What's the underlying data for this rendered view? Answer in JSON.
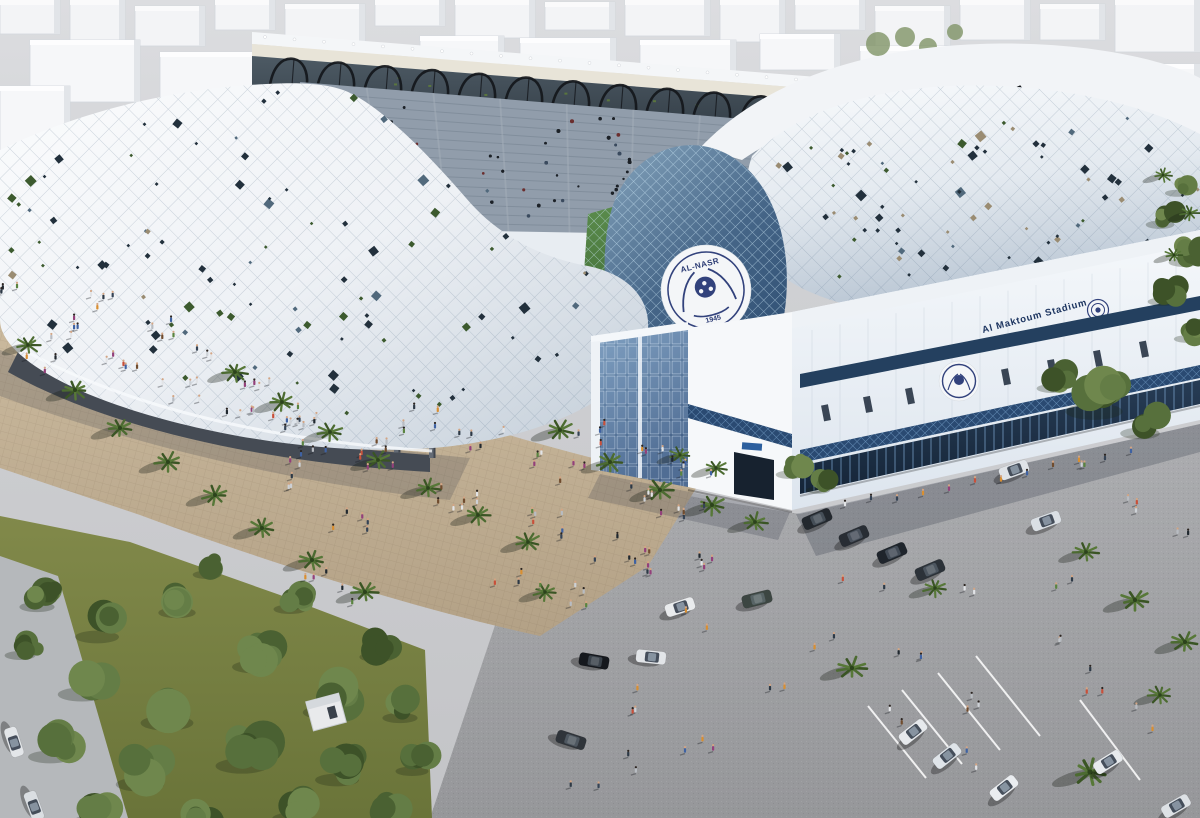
{
  "meta": {
    "description": "Aerial 3D architectural rendering of a stadium with a white perforated shell, glass entrance dome, palm-lined plaza, crowds and a parking lot",
    "render_size": "1200x818"
  },
  "stadium": {
    "facade_title": "Al Maktoum Stadium",
    "crest": {
      "club_name": "AL-NASR",
      "founded_year": "1945"
    }
  },
  "palette": {
    "shell_white": "#eef1f5",
    "shell_shade": "#c2cdd8",
    "dome_glass": "#466688",
    "band_navy": "#24405f",
    "lattice_navy": "#2a4a72",
    "text_navy": "#1d3560",
    "crest_navy": "#32427c",
    "pitch_green": "#4e7a3a",
    "palm_green": "#4c6b31",
    "tree_green": "#4a6132",
    "plaza_tan": "#c2b092",
    "asphalt_gray": "#a4a5a8",
    "ground_gray": "#d2d3d5",
    "city_white": "#f6f7f9",
    "truss_black": "#14171b"
  }
}
